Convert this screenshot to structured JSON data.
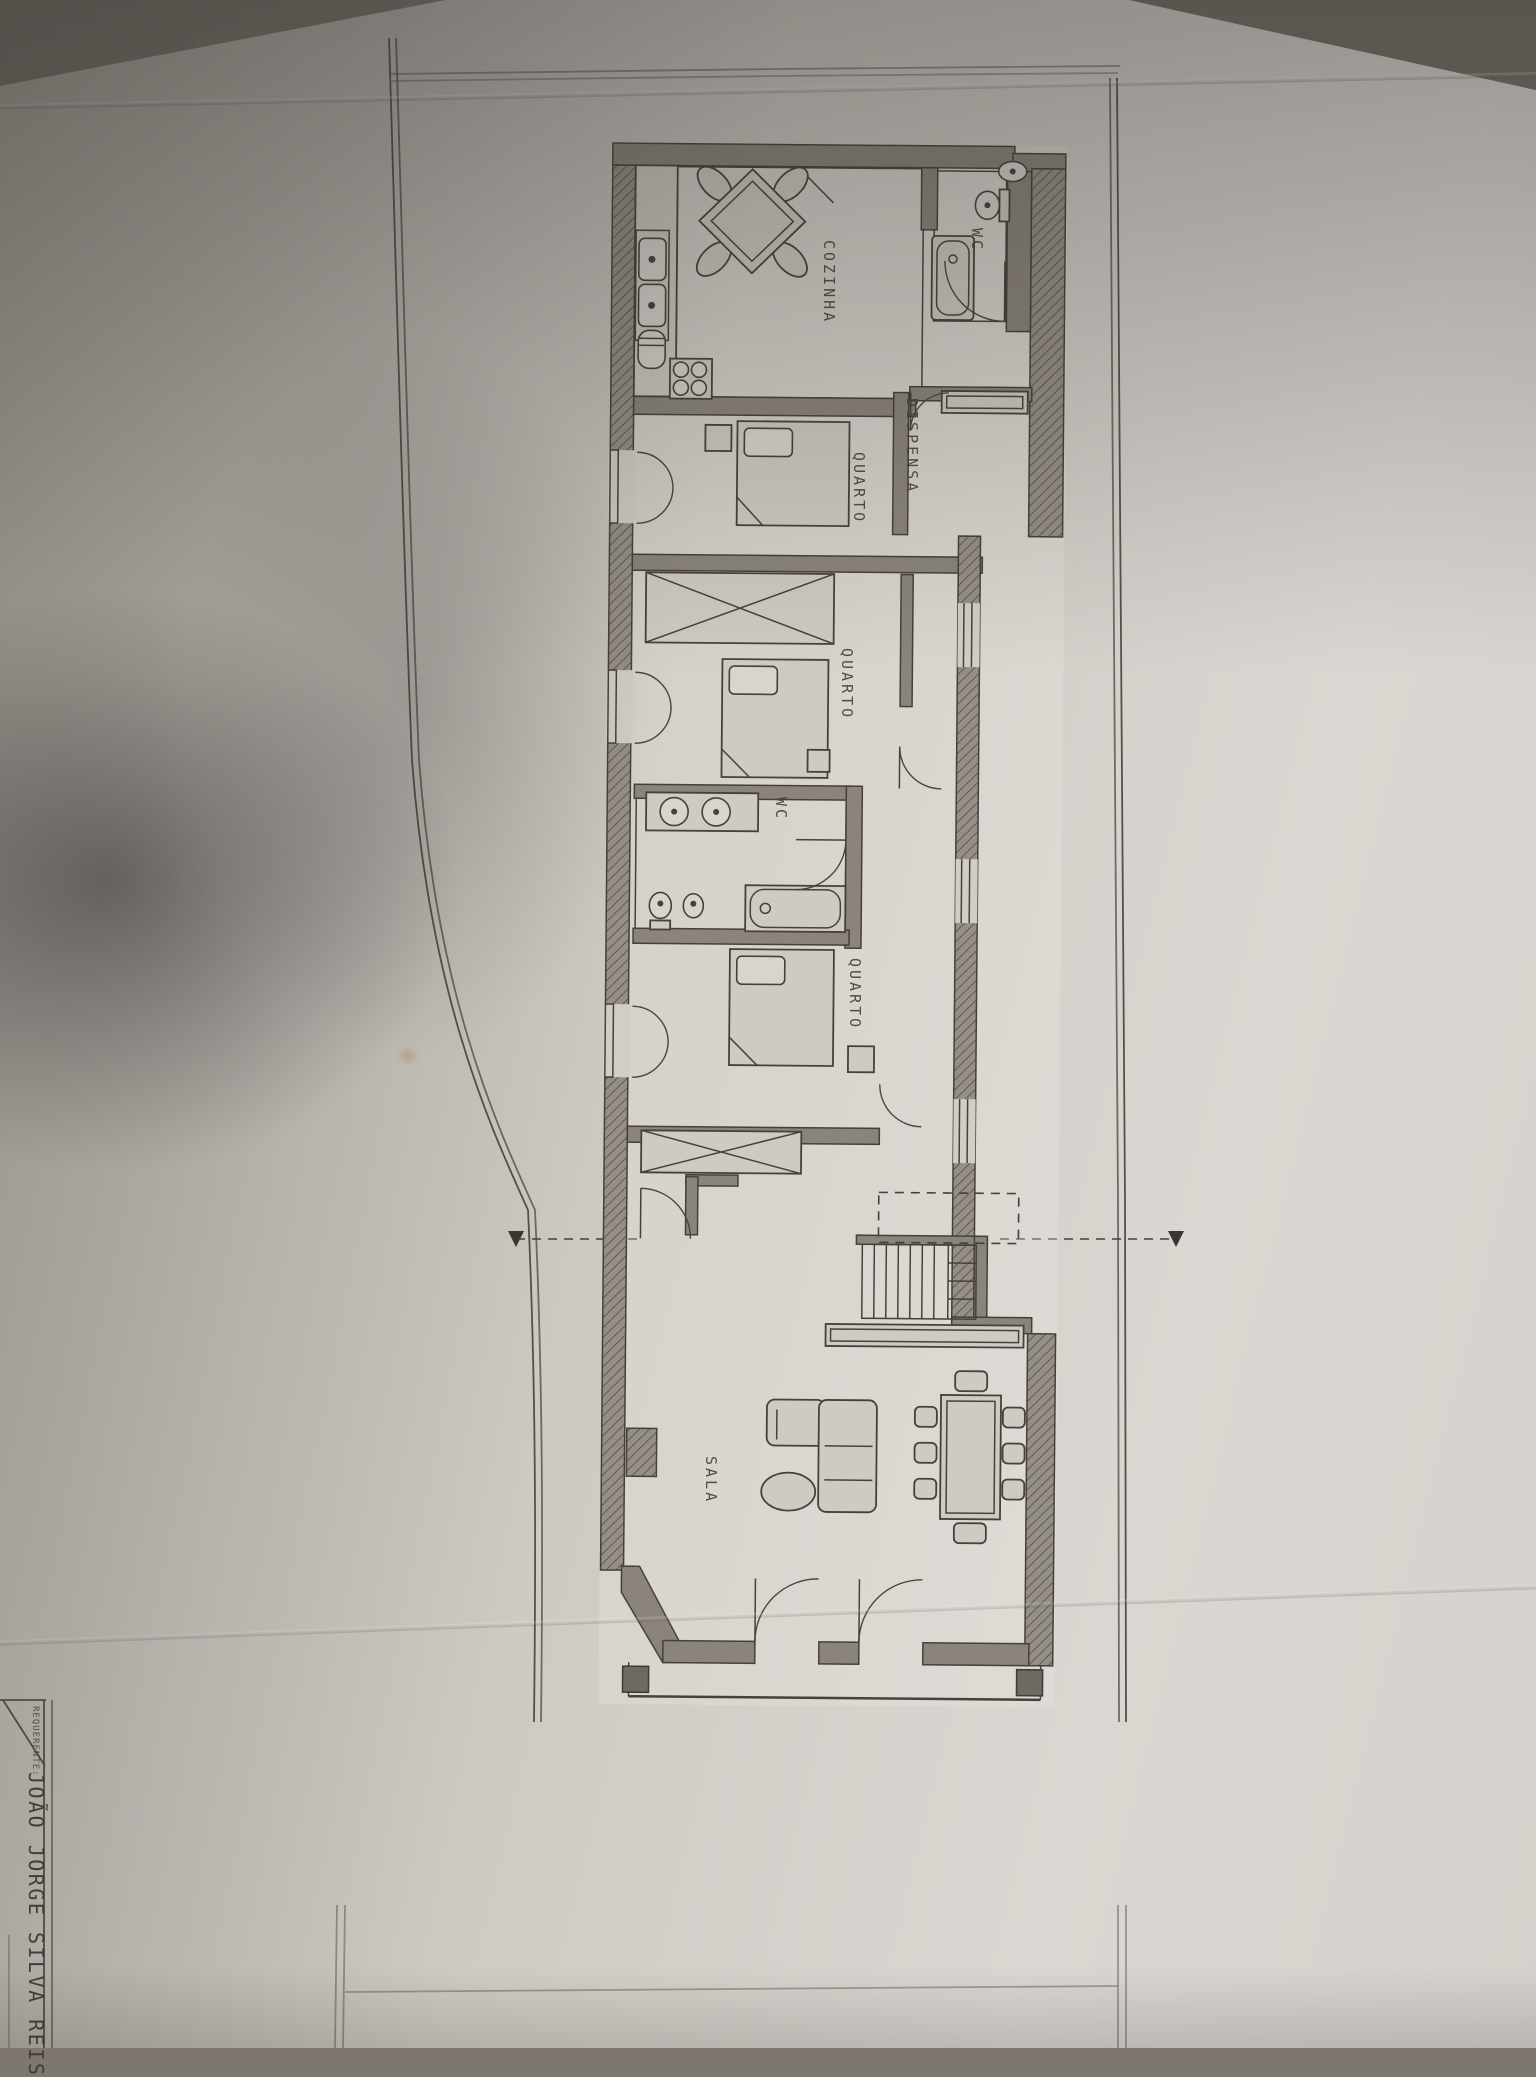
{
  "plan": {
    "rooms": [
      {
        "name": "kitchen",
        "label": "COZINHA"
      },
      {
        "name": "bathroom-top",
        "label": "WC"
      },
      {
        "name": "pantry",
        "label": "DISPENSA"
      },
      {
        "name": "bedroom-1",
        "label": "QUARTO"
      },
      {
        "name": "bedroom-2",
        "label": "QUARTO"
      },
      {
        "name": "bathroom-middle",
        "label": "WC"
      },
      {
        "name": "bedroom-3",
        "label": "QUARTO"
      },
      {
        "name": "living-room",
        "label": "SALA"
      }
    ]
  },
  "title_block": {
    "field_label": "REQUERENTE:",
    "applicant_name": "JOÃO JORGE SILVA REIS"
  },
  "colors": {
    "paper": "#d2cdc7",
    "background": "#7d7770",
    "ink": "#46413b",
    "wall_fill": "#8a847c",
    "stain": "#b09a62"
  }
}
